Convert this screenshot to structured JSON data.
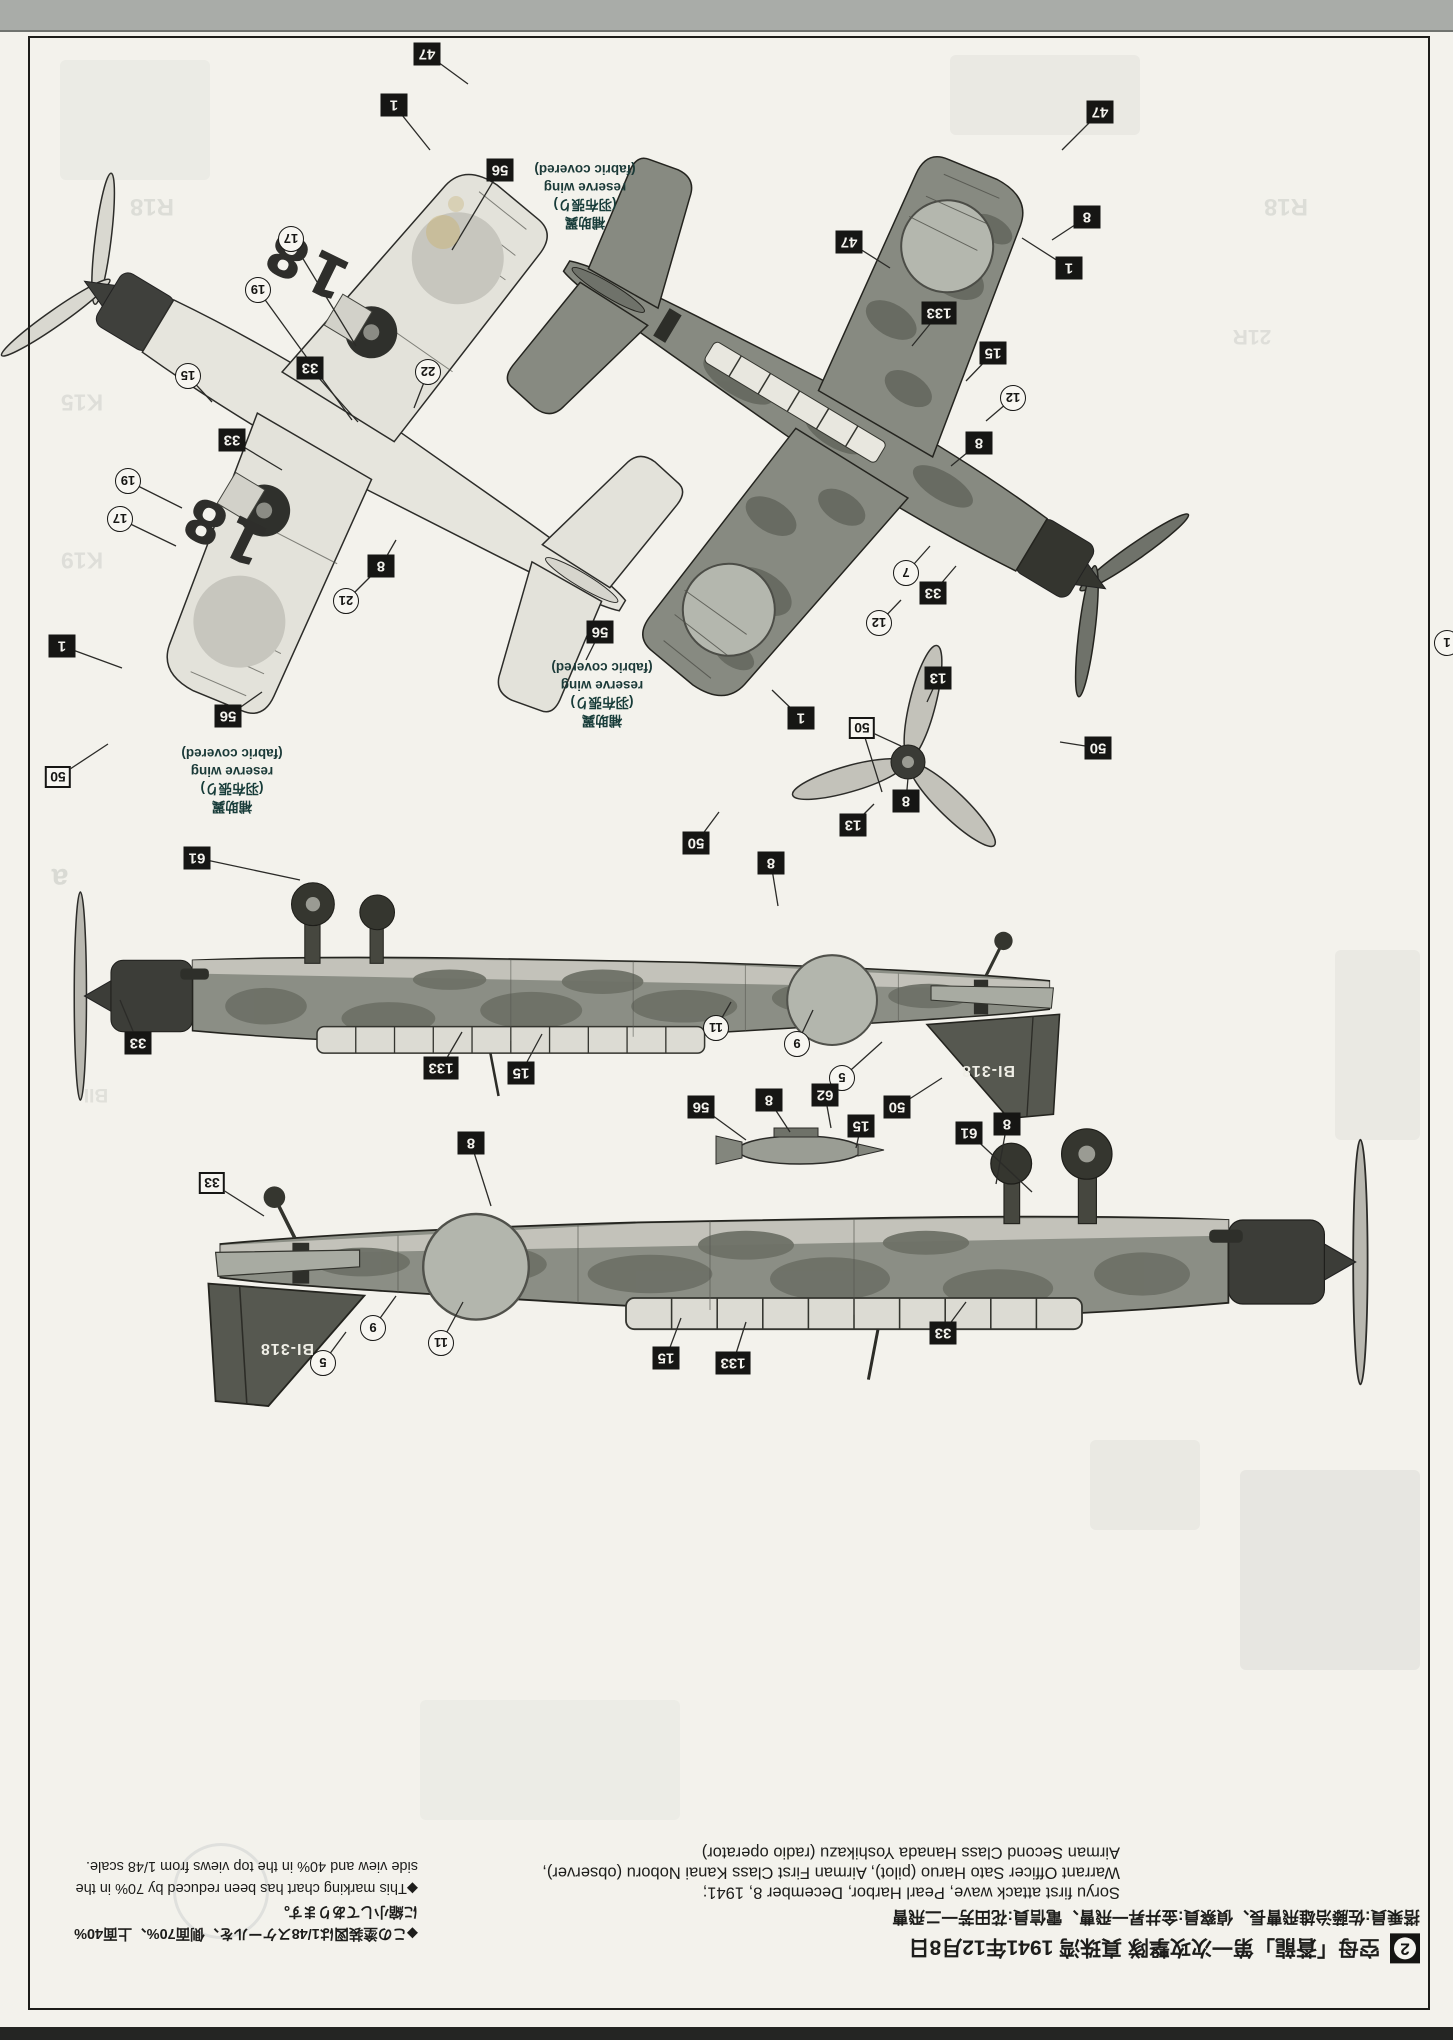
{
  "page": {
    "step": "2",
    "header_ja": "空母「蒼龍」第一次攻撃隊 真珠湾 1941年12月8日",
    "crew_ja": "搭乗員:佐藤治雄飛曹長、偵察員:金井昇一飛曹、電信員:花田芳一二飛曹",
    "caption_en_1": "Soryu first attack wave, Pearl Harbor, December 8, 1941;",
    "caption_en_2": "Warrant Officer Sato Haruo (pilot), Airman First Class Kanai Noboru (observer),",
    "caption_en_3": "Airman Second Class Hanada Yoshikazu (radio operator)",
    "note_ja_1": "◆この塗装図は1/48スケールを、側面70%、上面40%",
    "note_ja_2": "に縮小してあります。",
    "note_en_1": "◆This marking chart has been reduced by 70% in the",
    "note_en_2": "side view and 40% in the top views from 1/48 scale."
  },
  "labels": {
    "reserve_wing": [
      "補助翼",
      "(羽布張り)",
      "reserve wing",
      "(fabric covered)"
    ],
    "tail_code": "BI-318",
    "wing_code": "18"
  },
  "reserve_wing_labels": [
    {
      "x": 585,
      "y": 196
    },
    {
      "x": 602,
      "y": 694
    },
    {
      "x": 232,
      "y": 780
    }
  ],
  "tail_codes": [
    {
      "x": 988,
      "y": 1070
    },
    {
      "x": 287,
      "y": 1348
    }
  ],
  "wing_codes": [
    {
      "x": 306,
      "y": 264
    },
    {
      "x": 224,
      "y": 530
    }
  ],
  "callouts": [
    {
      "t": "47",
      "s": "b",
      "x": 427,
      "y": 54,
      "lx": 468,
      "ly": 84
    },
    {
      "t": "1",
      "s": "b",
      "x": 394,
      "y": 105,
      "lx": 430,
      "ly": 150
    },
    {
      "t": "56",
      "s": "b",
      "x": 500,
      "y": 170,
      "lx": 452,
      "ly": 250
    },
    {
      "t": "17",
      "s": "c",
      "x": 291,
      "y": 239,
      "lx": 356,
      "ly": 346
    },
    {
      "t": "19",
      "s": "c",
      "x": 258,
      "y": 290,
      "lx": 352,
      "ly": 420
    },
    {
      "t": "33",
      "s": "b",
      "x": 310,
      "y": 368,
      "lx": 358,
      "ly": 422
    },
    {
      "t": "15",
      "s": "c",
      "x": 188,
      "y": 376,
      "lx": 212,
      "ly": 402
    },
    {
      "t": "22",
      "s": "c",
      "x": 428,
      "y": 372,
      "lx": 414,
      "ly": 408
    },
    {
      "t": "33",
      "s": "b",
      "x": 232,
      "y": 440,
      "lx": 282,
      "ly": 470
    },
    {
      "t": "19",
      "s": "c",
      "x": 128,
      "y": 481,
      "lx": 182,
      "ly": 508
    },
    {
      "t": "17",
      "s": "c",
      "x": 120,
      "y": 519,
      "lx": 176,
      "ly": 546
    },
    {
      "t": "8",
      "s": "b",
      "x": 381,
      "y": 566,
      "lx": 396,
      "ly": 540
    },
    {
      "t": "21",
      "s": "c",
      "x": 346,
      "y": 601,
      "lx": 371,
      "ly": 576
    },
    {
      "t": "56",
      "s": "b",
      "x": 600,
      "y": 632,
      "lx": 586,
      "ly": 660
    },
    {
      "t": "1",
      "s": "b",
      "x": 62,
      "y": 646,
      "lx": 122,
      "ly": 668
    },
    {
      "t": "56",
      "s": "b",
      "x": 228,
      "y": 716,
      "lx": 262,
      "ly": 692
    },
    {
      "t": "50",
      "s": "w",
      "x": 58,
      "y": 777,
      "lx": 108,
      "ly": 744
    },
    {
      "t": "47",
      "s": "b",
      "x": 1100,
      "y": 112,
      "lx": 1062,
      "ly": 150
    },
    {
      "t": "8",
      "s": "b",
      "x": 1087,
      "y": 217,
      "lx": 1052,
      "ly": 240
    },
    {
      "t": "47",
      "s": "b",
      "x": 849,
      "y": 242,
      "lx": 890,
      "ly": 268
    },
    {
      "t": "1",
      "s": "b",
      "x": 1069,
      "y": 268,
      "lx": 1022,
      "ly": 238
    },
    {
      "t": "133",
      "s": "b",
      "x": 939,
      "y": 313,
      "lx": 912,
      "ly": 346
    },
    {
      "t": "15",
      "s": "b",
      "x": 993,
      "y": 353,
      "lx": 966,
      "ly": 381
    },
    {
      "t": "12",
      "s": "c",
      "x": 1013,
      "y": 398,
      "lx": 986,
      "ly": 421
    },
    {
      "t": "8",
      "s": "b",
      "x": 979,
      "y": 443,
      "lx": 951,
      "ly": 466
    },
    {
      "t": "7",
      "s": "c",
      "x": 906,
      "y": 573,
      "lx": 930,
      "ly": 546
    },
    {
      "t": "33",
      "s": "b",
      "x": 933,
      "y": 593,
      "lx": 956,
      "ly": 566
    },
    {
      "t": "12",
      "s": "c",
      "x": 879,
      "y": 623,
      "lx": 901,
      "ly": 600
    },
    {
      "t": "50",
      "s": "w",
      "x": 862,
      "y": 728,
      "lx": 901,
      "ly": 746,
      "lx2": 882,
      "ly2": 792
    },
    {
      "t": "13",
      "s": "b",
      "x": 938,
      "y": 678,
      "lx": 927,
      "ly": 702
    },
    {
      "t": "1",
      "s": "b",
      "x": 801,
      "y": 718,
      "lx": 772,
      "ly": 690
    },
    {
      "t": "8",
      "s": "b",
      "x": 906,
      "y": 801,
      "lx": 908,
      "ly": 778
    },
    {
      "t": "13",
      "s": "b",
      "x": 853,
      "y": 825,
      "lx": 874,
      "ly": 804
    },
    {
      "t": "50",
      "s": "b",
      "x": 696,
      "y": 843,
      "lx": 719,
      "ly": 812
    },
    {
      "t": "50",
      "s": "b",
      "x": 1098,
      "y": 748,
      "lx": 1060,
      "ly": 742
    },
    {
      "t": "1",
      "s": "c",
      "x": 1447,
      "y": 643
    },
    {
      "t": "61",
      "s": "b",
      "x": 197,
      "y": 858,
      "lx": 300,
      "ly": 880
    },
    {
      "t": "8",
      "s": "b",
      "x": 771,
      "y": 863,
      "lx": 778,
      "ly": 906
    },
    {
      "t": "33",
      "s": "b",
      "x": 138,
      "y": 1043,
      "lx": 120,
      "ly": 1000
    },
    {
      "t": "133",
      "s": "b",
      "x": 441,
      "y": 1068,
      "lx": 462,
      "ly": 1032
    },
    {
      "t": "15",
      "s": "b",
      "x": 521,
      "y": 1073,
      "lx": 542,
      "ly": 1034
    },
    {
      "t": "11",
      "s": "c",
      "x": 716,
      "y": 1028,
      "lx": 731,
      "ly": 1002
    },
    {
      "t": "9",
      "s": "c",
      "x": 797,
      "y": 1044,
      "lx": 813,
      "ly": 1010
    },
    {
      "t": "5",
      "s": "c",
      "x": 842,
      "y": 1078,
      "lx": 882,
      "ly": 1042
    },
    {
      "t": "50",
      "s": "b",
      "x": 897,
      "y": 1107,
      "lx": 942,
      "ly": 1078
    },
    {
      "t": "8",
      "s": "b",
      "x": 1007,
      "y": 1124,
      "lx": 996,
      "ly": 1184
    },
    {
      "t": "56",
      "s": "b",
      "x": 701,
      "y": 1107,
      "lx": 746,
      "ly": 1140
    },
    {
      "t": "8",
      "s": "b",
      "x": 769,
      "y": 1100,
      "lx": 790,
      "ly": 1132
    },
    {
      "t": "62",
      "s": "b",
      "x": 825,
      "y": 1095,
      "lx": 831,
      "ly": 1128
    },
    {
      "t": "15",
      "s": "b",
      "x": 861,
      "y": 1126,
      "lx": 856,
      "ly": 1148
    },
    {
      "t": "61",
      "s": "b",
      "x": 969,
      "y": 1133,
      "lx": 1032,
      "ly": 1192
    },
    {
      "t": "8",
      "s": "b",
      "x": 471,
      "y": 1143,
      "lx": 491,
      "ly": 1206
    },
    {
      "t": "33",
      "s": "w",
      "x": 212,
      "y": 1183,
      "lx": 264,
      "ly": 1216
    },
    {
      "t": "9",
      "s": "c",
      "x": 373,
      "y": 1328,
      "lx": 396,
      "ly": 1296
    },
    {
      "t": "11",
      "s": "c",
      "x": 441,
      "y": 1343,
      "lx": 463,
      "ly": 1302
    },
    {
      "t": "5",
      "s": "c",
      "x": 323,
      "y": 1363,
      "lx": 346,
      "ly": 1332
    },
    {
      "t": "15",
      "s": "b",
      "x": 666,
      "y": 1358,
      "lx": 681,
      "ly": 1318
    },
    {
      "t": "133",
      "s": "b",
      "x": 733,
      "y": 1363,
      "lx": 746,
      "ly": 1322
    },
    {
      "t": "33",
      "s": "b",
      "x": 943,
      "y": 1333,
      "lx": 966,
      "ly": 1302
    }
  ],
  "show_through_texts": [
    {
      "t": "R18",
      "x": 152,
      "y": 206,
      "fs": 24,
      "o": 0.22
    },
    {
      "t": "R18",
      "x": 1286,
      "y": 206,
      "fs": 24,
      "o": 0.22
    },
    {
      "t": "21R",
      "x": 1252,
      "y": 336,
      "fs": 21,
      "o": 0.2
    },
    {
      "t": "K15",
      "x": 82,
      "y": 402,
      "fs": 23,
      "o": 0.2
    },
    {
      "t": "K19",
      "x": 82,
      "y": 560,
      "fs": 23,
      "o": 0.2
    },
    {
      "t": "a",
      "x": 60,
      "y": 878,
      "fs": 30,
      "o": 0.25
    },
    {
      "t": "BII",
      "x": 96,
      "y": 1094,
      "fs": 19,
      "o": 0.18
    }
  ],
  "show_through_patches": [
    {
      "x": 1240,
      "y": 1470,
      "w": 180,
      "h": 200,
      "o": 0.1
    },
    {
      "x": 1090,
      "y": 1440,
      "w": 110,
      "h": 90,
      "o": 0.08
    },
    {
      "x": 1335,
      "y": 950,
      "w": 85,
      "h": 190,
      "o": 0.08
    },
    {
      "x": 60,
      "y": 60,
      "w": 150,
      "h": 120,
      "o": 0.06
    },
    {
      "x": 950,
      "y": 55,
      "w": 190,
      "h": 80,
      "o": 0.08
    },
    {
      "x": 420,
      "y": 1700,
      "w": 260,
      "h": 120,
      "o": 0.05
    }
  ],
  "stains": [
    {
      "x": 443,
      "y": 232,
      "r": 17,
      "c": "#c9b478",
      "o": 0.5
    },
    {
      "x": 456,
      "y": 204,
      "r": 8,
      "c": "#c9b478",
      "o": 0.38
    }
  ]
}
